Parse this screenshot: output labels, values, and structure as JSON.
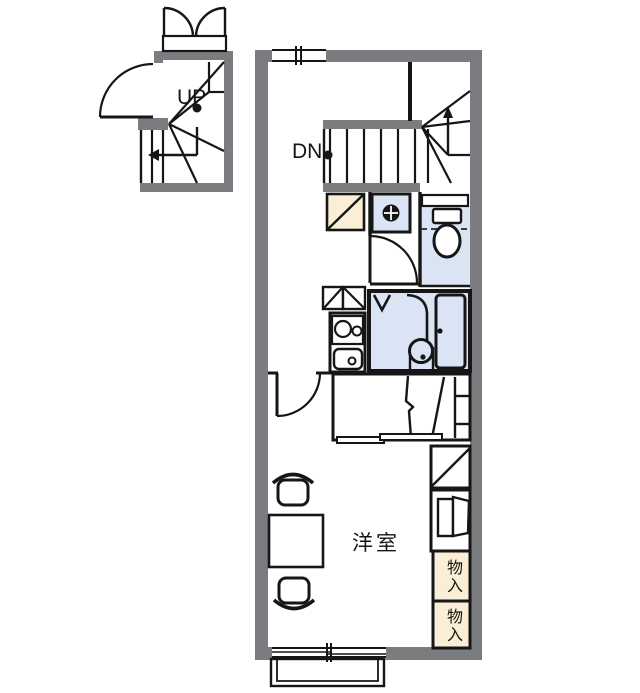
{
  "floorplan": {
    "labels": {
      "up": "UP",
      "down": "DN",
      "room": "洋室",
      "storage_top": "物入",
      "storage_bottom": "物入"
    },
    "colors": {
      "wall_gray": "#7b7c80",
      "water_area_blue": "#dbe4f4",
      "storage_cream": "#fbeed6",
      "line_black": "#161616",
      "background": "#ffffff"
    }
  }
}
